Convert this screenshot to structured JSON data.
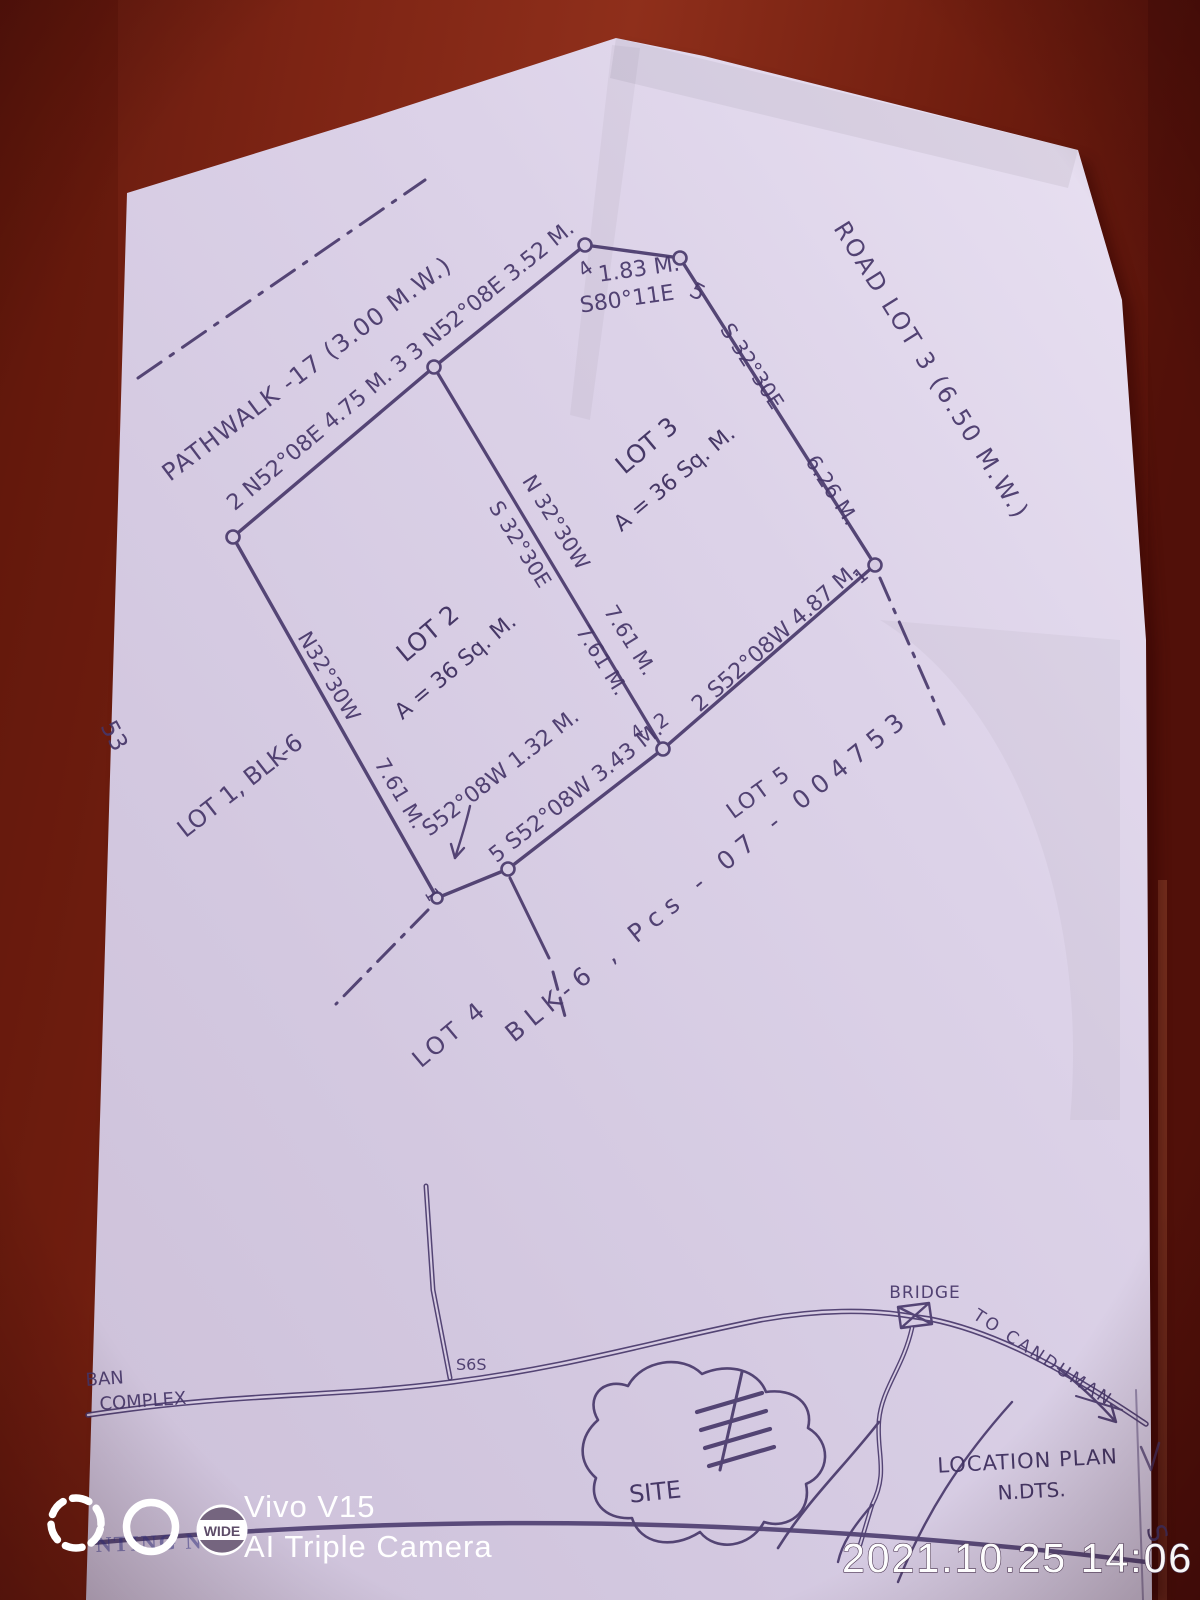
{
  "colors": {
    "wood": "#8f2f1b",
    "wood_dark": "#56120a",
    "paper": "#d7cce3",
    "ink": "#463669",
    "watermark_white": "#ffffff"
  },
  "plan": {
    "road_labels": {
      "pathwalk": "PATHWALK -17 (3.00 M.W.)",
      "road_lot3": "ROAD LOT 3 (6.50 M.W.)"
    },
    "bearings": {
      "edge_2_3": "2 N52°08E   4.75 M.  3",
      "edge_3_4": "3 N52°08E  3.52 M.",
      "edge_4_5_distance": "1.83 M.",
      "edge_4_5_bearing": "S80°11E",
      "edge_5_1_bearing": "S 32°30E",
      "edge_5_1_distance": "6.26 M.",
      "edge_1_2": "2  S52°08W  4.87 M.",
      "edge_bottom_lot2": "5 S52°08W  3.43 M.",
      "edge_short": "S52°08W 1.32 M.",
      "divider_bearing_north": "N 32°30W",
      "divider_bearing_south": "S 32°30E",
      "divider_distance_a": "7.61 M.",
      "divider_distance_b": "7.61 M.",
      "edge_left_bearing": "N32°30W",
      "edge_left_distance": "7.61 M."
    },
    "vertices": {
      "v4_top": "4",
      "v5_top": "5",
      "v1_right": "1",
      "v2_shared": "2",
      "v4_shared": "4",
      "v1_bottom": "1"
    },
    "lots": {
      "lot2_name": "LOT 2",
      "lot2_area": "A = 36 Sq. M.",
      "lot3_name": "LOT 3",
      "lot3_area": "A = 36 Sq. M.",
      "lot1": "LOT 1, BLK-6",
      "lot4": "LOT 4",
      "lot5": "LOT 5",
      "block_ref": "BLK-6 , Pcs - 07 - 004753",
      "edge_fragment": "53"
    }
  },
  "location_plan": {
    "complex_line1": "BAN",
    "complex_line2": "COMPLEX",
    "junction": "S6S",
    "bridge": "BRIDGE",
    "to_canduman": "TO CANDUMAN",
    "site": "SITE",
    "title_line1": "LOCATION PLAN",
    "title_line2": "N.DTS.",
    "south_marker": "S"
  },
  "letterhead_fragment": "NTING  NC",
  "watermark": {
    "device": "Vivo V15",
    "camera_mode": "AI Triple Camera",
    "wide_badge": "WIDE",
    "timestamp": "2021.10.25 14:06"
  }
}
